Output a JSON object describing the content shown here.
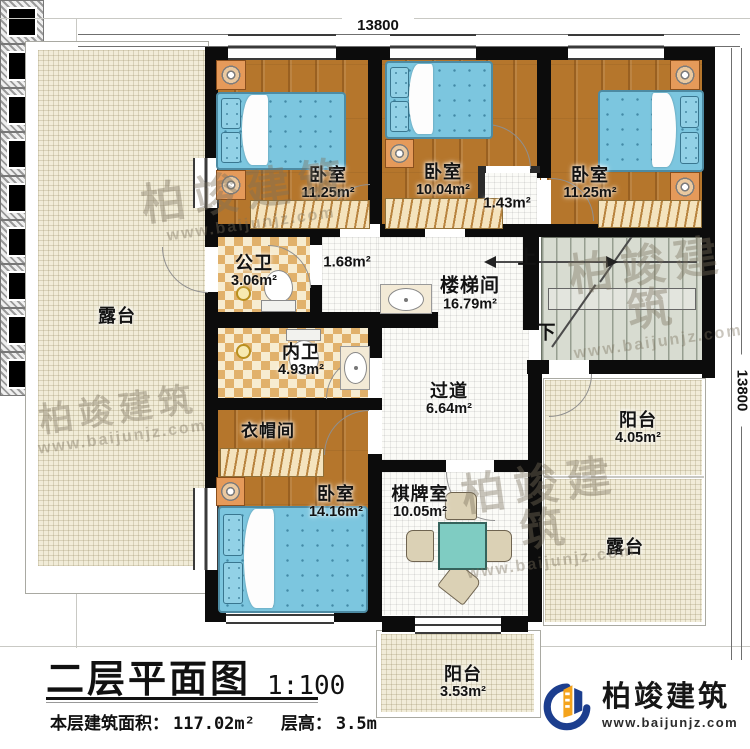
{
  "title_block": {
    "title": "二层平面图",
    "scale": "1:100",
    "area_label": "本层建筑面积：",
    "area_value": "117.02m²",
    "height_label": "层高：",
    "height_value": "3.5m"
  },
  "dimensions": {
    "top": "13800",
    "right": "13800"
  },
  "stairs": {
    "up_label": "上",
    "down_label": "下"
  },
  "rooms": {
    "bedroom_top_left": {
      "name": "卧室",
      "area": "11.25m²"
    },
    "bedroom_top_mid": {
      "name": "卧室",
      "area": "10.04m²"
    },
    "bedroom_top_right": {
      "name": "卧室",
      "area": "11.25m²"
    },
    "niche": {
      "area": "1.43m²"
    },
    "vestibule": {
      "area": "1.68m²"
    },
    "public_bath": {
      "name": "公卫",
      "area": "3.06m²"
    },
    "inner_bath": {
      "name": "内卫",
      "area": "4.93m²"
    },
    "stairwell": {
      "name": "楼梯间",
      "area": "16.79m²"
    },
    "corridor": {
      "name": "过道",
      "area": "6.64m²"
    },
    "cloakroom": {
      "name": "衣帽间"
    },
    "bedroom_bottom": {
      "name": "卧室",
      "area": "14.16m²"
    },
    "game_room": {
      "name": "棋牌室",
      "area": "10.05m²"
    },
    "terrace_left": {
      "name": "露台"
    },
    "terrace_right": {
      "name": "露台"
    },
    "balcony_right": {
      "name": "阳台",
      "area": "4.05m²"
    },
    "balcony_bottom": {
      "name": "阳台",
      "area": "3.53m²"
    }
  },
  "branding": {
    "company": "柏竣建筑",
    "website": "www.baijunjz.com"
  },
  "watermark": {
    "text": "柏竣建筑",
    "subtext": "www.baijunjz.com"
  },
  "colors": {
    "wall": "#0c0c0c",
    "wood": "#b5762c",
    "bed": "#7cc6df",
    "terrace": "#f1ecd8",
    "checker": "#e1b16b",
    "stair": "#d8dcd1",
    "logo_blue": "#1c3e8e",
    "logo_orange": "#f4a31c"
  }
}
